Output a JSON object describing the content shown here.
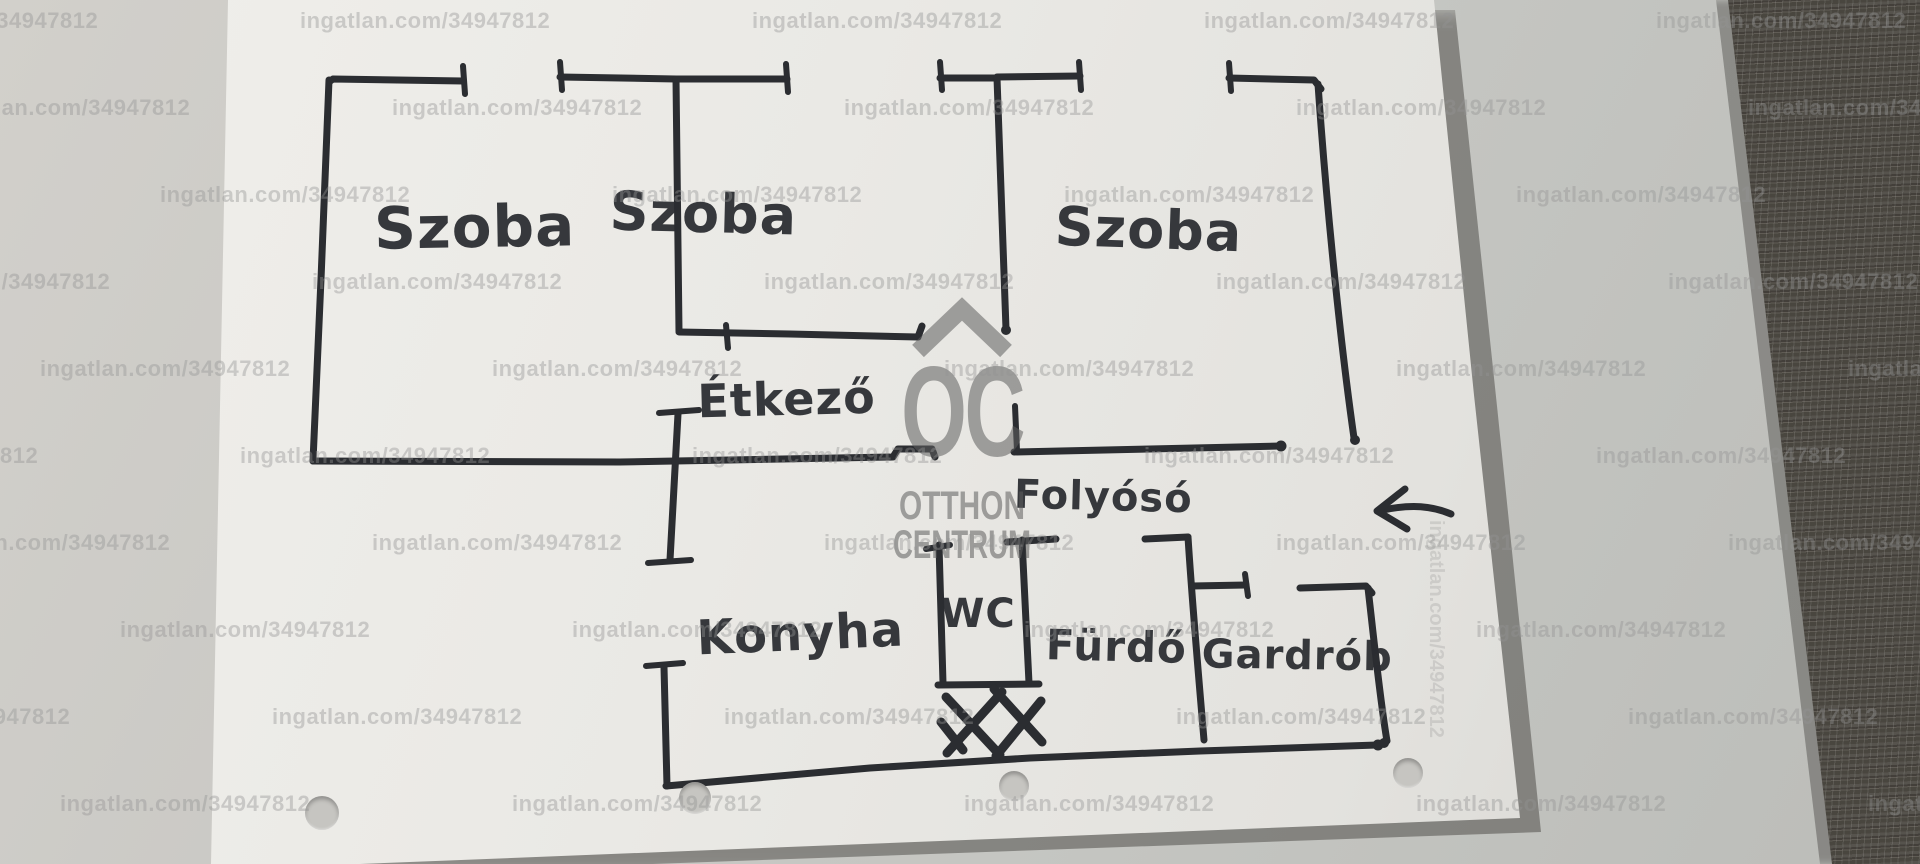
{
  "photo": {
    "watermark": {
      "text": "ingatlan.com/34947812"
    },
    "agency_logo": {
      "monogram": "OC",
      "line1": "OTTHON",
      "line2": "CENTRUM"
    },
    "floorplan": {
      "rooms": [
        {
          "id": "szoba-1",
          "label": "Szoba"
        },
        {
          "id": "szoba-2",
          "label": "Szoba"
        },
        {
          "id": "szoba-3",
          "label": "Szoba"
        },
        {
          "id": "etkezo",
          "label": "Étkező"
        },
        {
          "id": "folyoso",
          "label": "Folyósó"
        },
        {
          "id": "konyha",
          "label": "Konyha"
        },
        {
          "id": "wc",
          "label": "WC"
        },
        {
          "id": "furdo",
          "label": "Fürdő"
        },
        {
          "id": "gardrob",
          "label": "Gardrób"
        }
      ],
      "entrance_arrow_direction": "left"
    },
    "colors": {
      "marker": "#2b2d31",
      "paper": "#e9e8e4",
      "table": "#c8c7c3",
      "fabric": "#514e49",
      "watermark_gray": "#949494",
      "logo_gray": "#5f5f5f"
    }
  }
}
